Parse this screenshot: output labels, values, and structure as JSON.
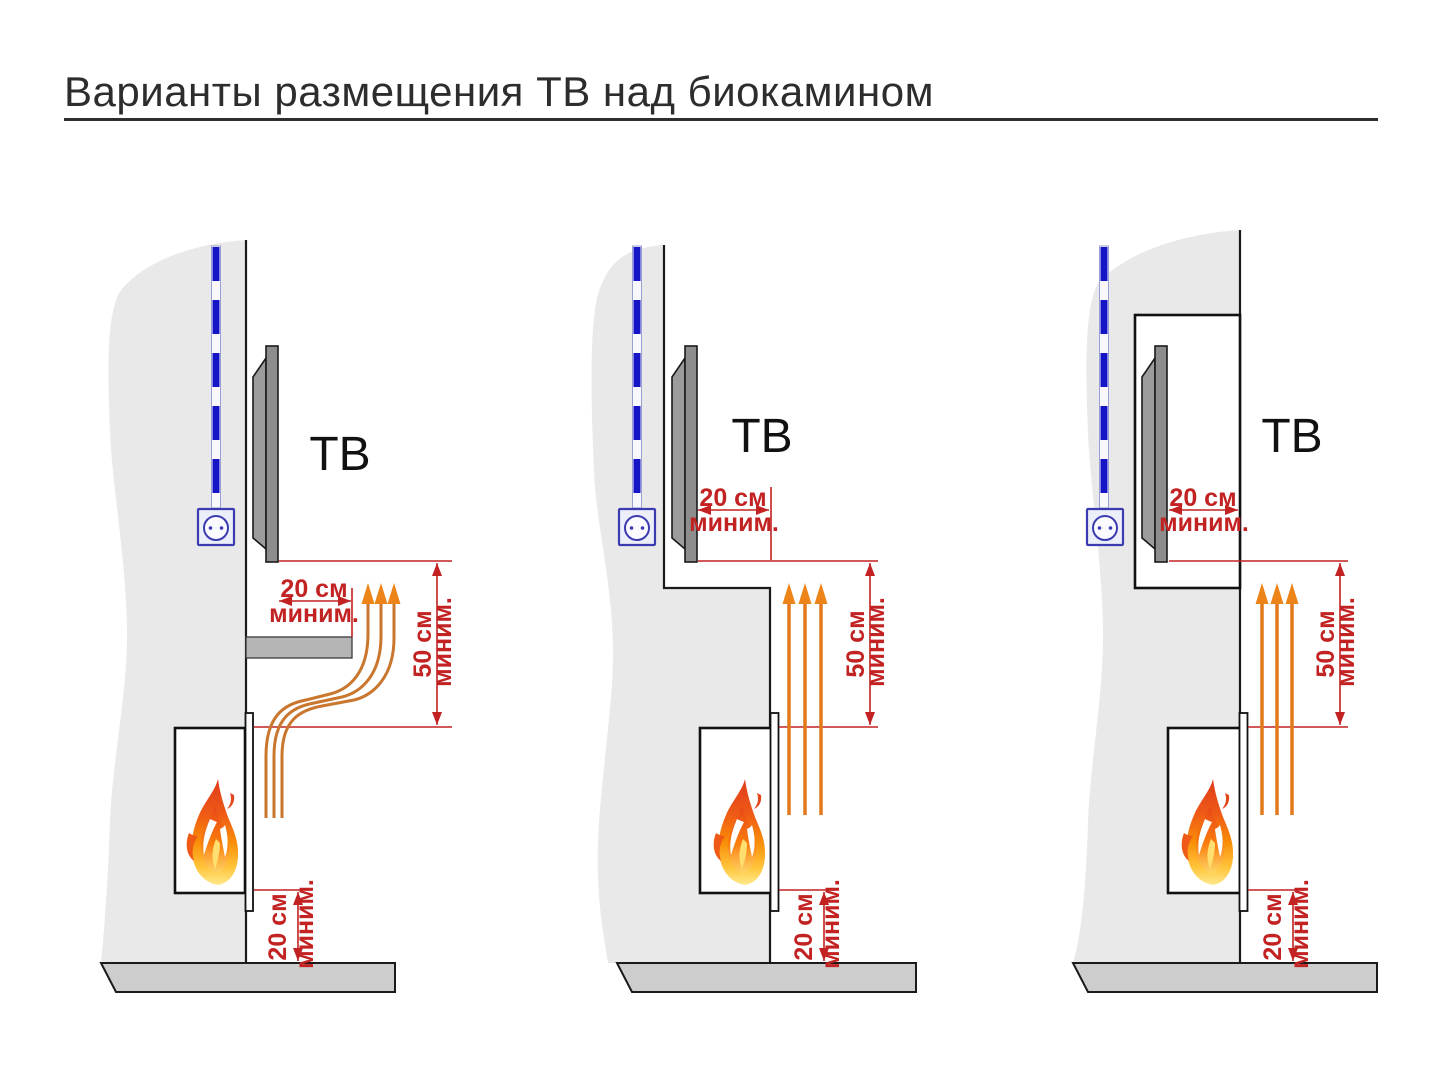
{
  "title": "Варианты размещения ТВ над биокамином",
  "variants": [
    {
      "tv_label": "ТВ",
      "side_clearance": {
        "value": "20 см",
        "qualifier": "миним."
      },
      "above_fireplace_clearance": {
        "value": "50 см",
        "qualifier": "миним."
      },
      "floor_clearance": {
        "value": "20 см",
        "qualifier": "миним."
      }
    },
    {
      "tv_label": "ТВ",
      "side_clearance": {
        "value": "20 см",
        "qualifier": "миним."
      },
      "above_fireplace_clearance": {
        "value": "50 см",
        "qualifier": "миним."
      },
      "floor_clearance": {
        "value": "20 см",
        "qualifier": "миним."
      }
    },
    {
      "tv_label": "ТВ",
      "side_clearance": {
        "value": "20 см",
        "qualifier": "миним."
      },
      "above_fireplace_clearance": {
        "value": "50 см",
        "qualifier": "миним."
      },
      "floor_clearance": {
        "value": "20 см",
        "qualifier": "миним."
      }
    }
  ],
  "colors": {
    "dimension_red": "#c22222",
    "heat_orange": "#e8821c",
    "heat_arrowhead_orange": "#ec8418",
    "cable_blue": "#1515c5",
    "outlet_blue": "#3c3cb0",
    "wall_gray": "#e9e9e9",
    "tv_gray": "#8d8d8d",
    "shelf_gray": "#b5b5b5",
    "floor_gray": "#cdcdcd",
    "title_color": "#2d2d2d"
  }
}
